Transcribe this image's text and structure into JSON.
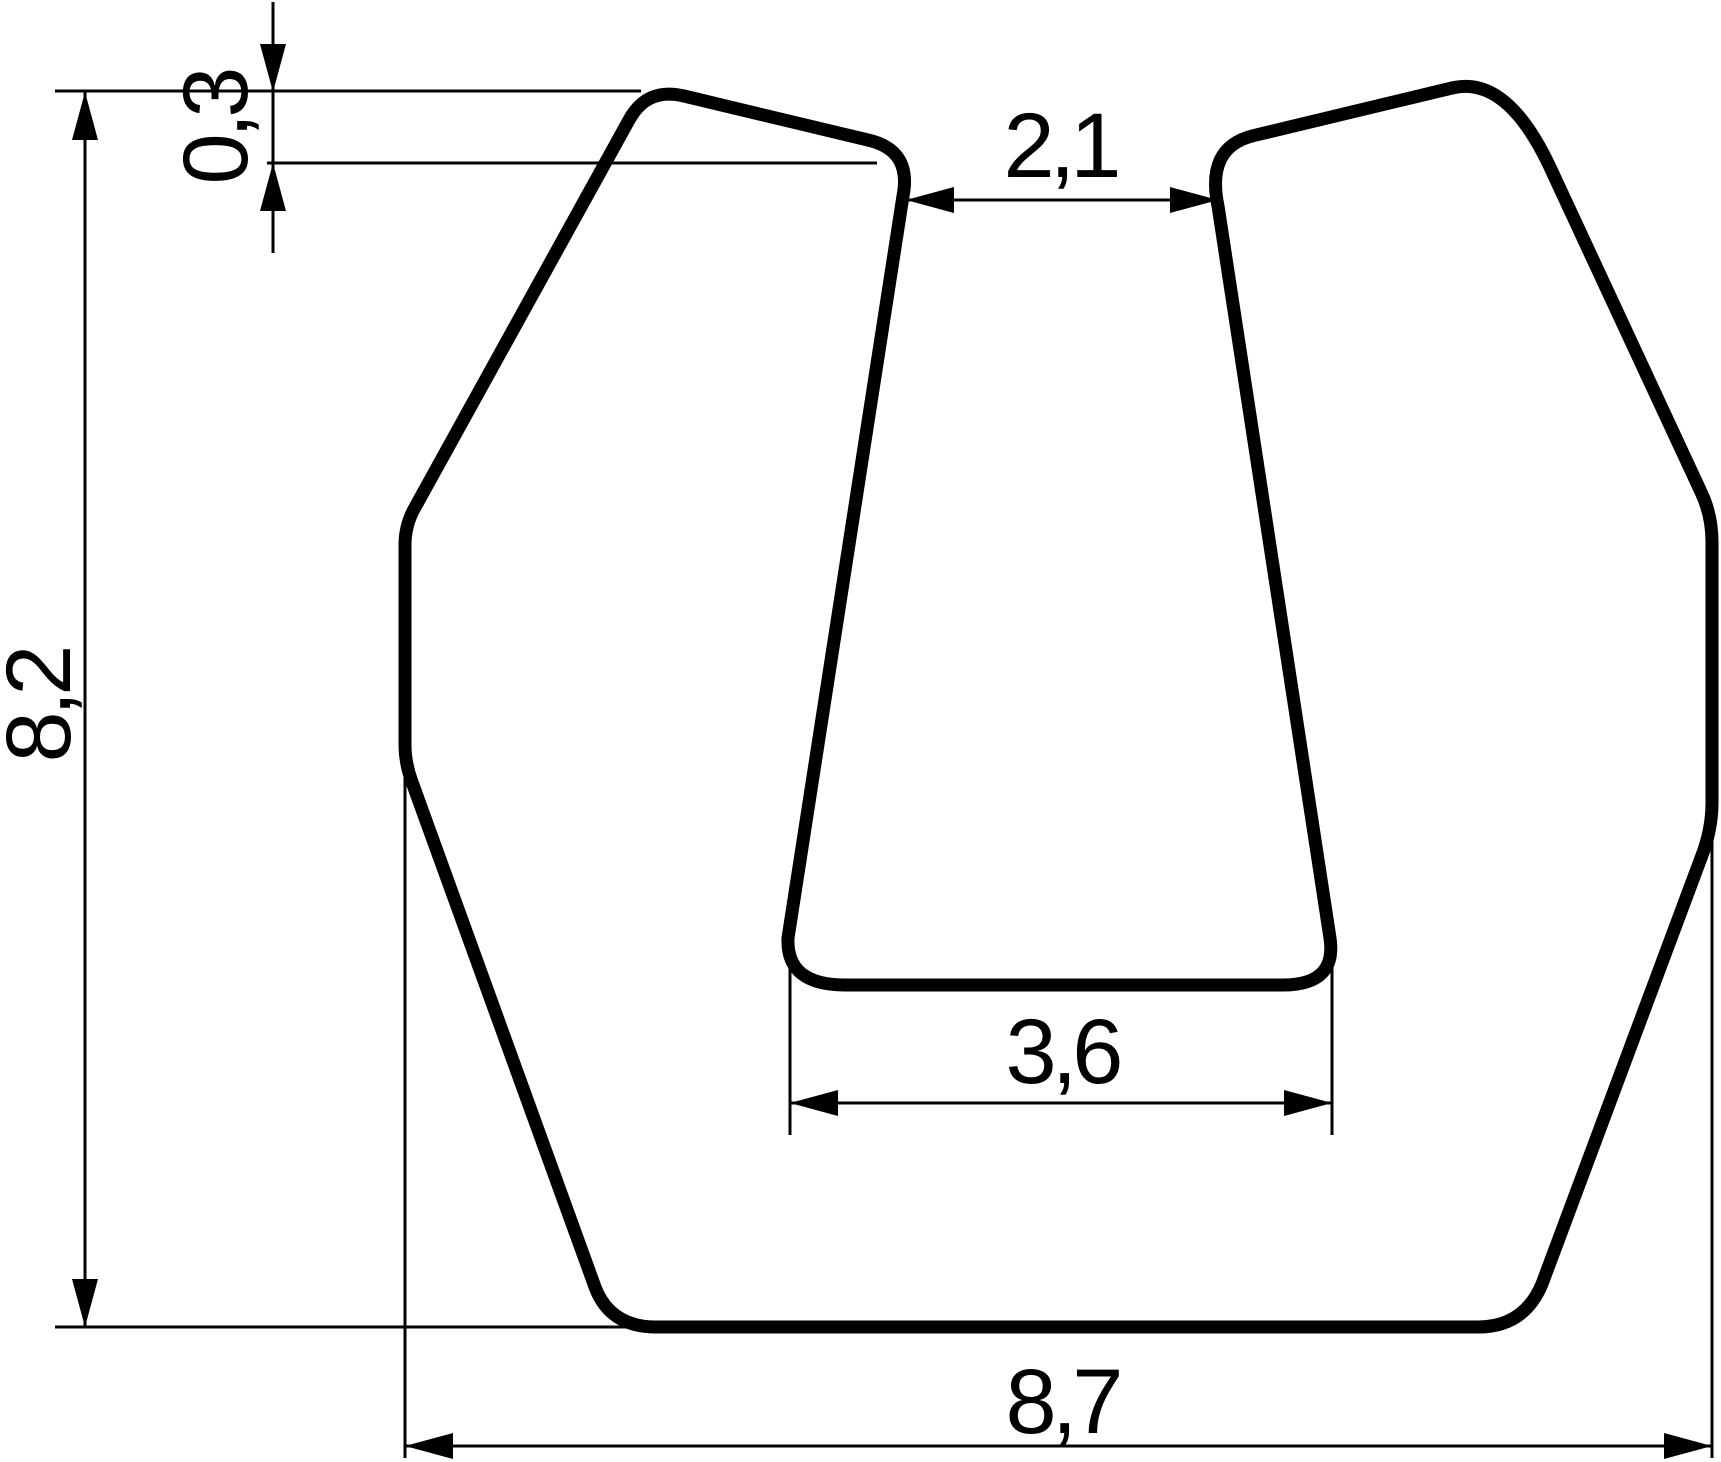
{
  "drawing": {
    "kind": "technical-profile-cross-section",
    "colors": {
      "background": "#ffffff",
      "line": "#000000"
    },
    "dimensions": {
      "overall_height": "8,2",
      "lip_height": "0,3",
      "slot_top_width": "2,1",
      "slot_bottom_width": "3,6",
      "overall_width": "8,7"
    }
  }
}
